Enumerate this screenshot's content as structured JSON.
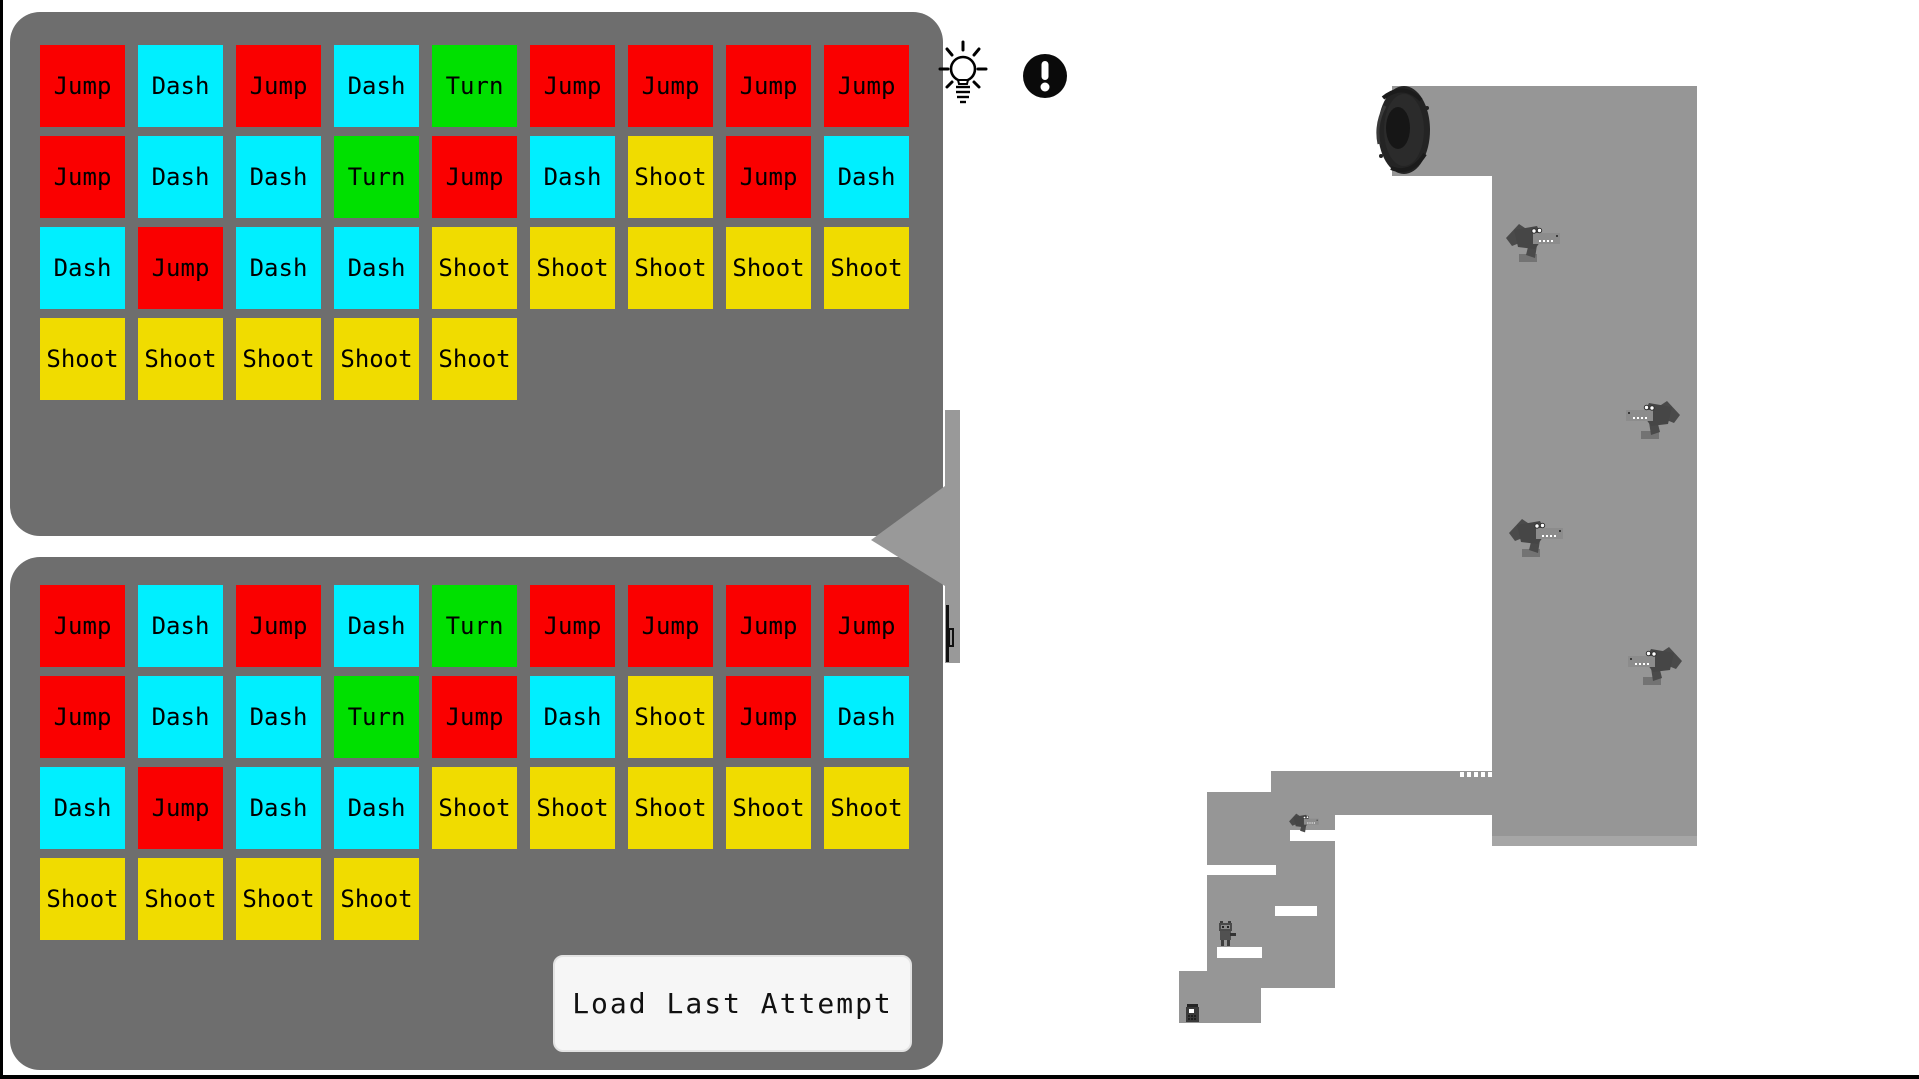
{
  "window": {
    "background": "#FFFFFF",
    "edge_color": "#000000"
  },
  "palette": {
    "panel_gray": "#6E6E6E",
    "map_gray": "#969696",
    "map_floor_strip": "#A6A6A6",
    "connector_gray": "#999999",
    "button_bg": "#F6F6F6",
    "tile_text": "#000000",
    "croc_body": "#4A4A4A",
    "croc_snout": "#8C8C8C",
    "croc_block": "#737373"
  },
  "actions": {
    "jump": {
      "label": "Jump",
      "color": "#FA0000"
    },
    "dash": {
      "label": "Dash",
      "color": "#00EFFF"
    },
    "turn": {
      "label": "Turn",
      "color": "#00E000"
    },
    "shoot": {
      "label": "Shoot",
      "color": "#F0DC00"
    }
  },
  "top_panel": {
    "rows": [
      [
        "jump",
        "dash",
        "jump",
        "dash",
        "turn",
        "jump",
        "jump",
        "jump",
        "jump"
      ],
      [
        "jump",
        "dash",
        "dash",
        "turn",
        "jump",
        "dash",
        "shoot",
        "jump",
        "dash"
      ],
      [
        "dash",
        "jump",
        "dash",
        "dash",
        "shoot",
        "shoot",
        "shoot",
        "shoot",
        "shoot"
      ],
      [
        "shoot",
        "shoot",
        "shoot",
        "shoot",
        "shoot"
      ]
    ]
  },
  "bottom_panel": {
    "rows": [
      [
        "jump",
        "dash",
        "jump",
        "dash",
        "turn",
        "jump",
        "jump",
        "jump",
        "jump"
      ],
      [
        "jump",
        "dash",
        "dash",
        "turn",
        "jump",
        "dash",
        "shoot",
        "jump",
        "dash"
      ],
      [
        "dash",
        "jump",
        "dash",
        "dash",
        "shoot",
        "shoot",
        "shoot",
        "shoot",
        "shoot"
      ],
      [
        "shoot",
        "shoot",
        "shoot",
        "shoot"
      ]
    ],
    "button_label": "Load Last Attempt"
  },
  "icons": {
    "hint": "lightbulb",
    "alert": "exclamation-circle"
  },
  "map": {
    "rects": [
      {
        "name": "top-bar",
        "x": 1392,
        "y": 86,
        "w": 305,
        "h": 90
      },
      {
        "name": "corridor",
        "x": 1492,
        "y": 176,
        "w": 205,
        "h": 670
      },
      {
        "name": "bridge",
        "x": 1271,
        "y": 771,
        "w": 221,
        "h": 44
      },
      {
        "name": "left-column",
        "x": 1207,
        "y": 792,
        "w": 128,
        "h": 196
      },
      {
        "name": "bottom-block",
        "x": 1179,
        "y": 971,
        "w": 82,
        "h": 52
      },
      {
        "name": "floor-strip",
        "x": 1492,
        "y": 836,
        "w": 205,
        "h": 10,
        "light": true
      }
    ],
    "slots": [
      {
        "name": "ledge-slot-1",
        "x": 1206,
        "y": 865,
        "w": 70,
        "h": 10
      },
      {
        "name": "ledge-slot-2",
        "x": 1275,
        "y": 906,
        "w": 42,
        "h": 10
      },
      {
        "name": "ledge-slot-3",
        "x": 1217,
        "y": 947,
        "w": 45,
        "h": 11
      },
      {
        "name": "ledge-slot-4",
        "x": 1290,
        "y": 830,
        "w": 45,
        "h": 11
      }
    ],
    "serration": {
      "x": 1460,
      "y": 772,
      "count": 5,
      "step": 7
    },
    "portal": {
      "x": 1373,
      "y": 84,
      "w": 60,
      "h": 92
    },
    "enemies": [
      {
        "name": "croc",
        "x": 1504,
        "y": 221,
        "facing": "right",
        "scale": 1,
        "block": true
      },
      {
        "name": "croc",
        "x": 1626,
        "y": 398,
        "facing": "left",
        "scale": 1,
        "block": true
      },
      {
        "name": "croc",
        "x": 1507,
        "y": 516,
        "facing": "right",
        "scale": 1,
        "block": true
      },
      {
        "name": "croc",
        "x": 1628,
        "y": 644,
        "facing": "left",
        "scale": 1,
        "block": true
      },
      {
        "name": "croc",
        "x": 1288,
        "y": 812,
        "facing": "right",
        "scale": 0.55,
        "block": false
      }
    ],
    "player": {
      "name": "robot",
      "x": 1217,
      "y": 921
    },
    "item": {
      "name": "pickup-robot",
      "x": 1185,
      "y": 1004
    }
  }
}
